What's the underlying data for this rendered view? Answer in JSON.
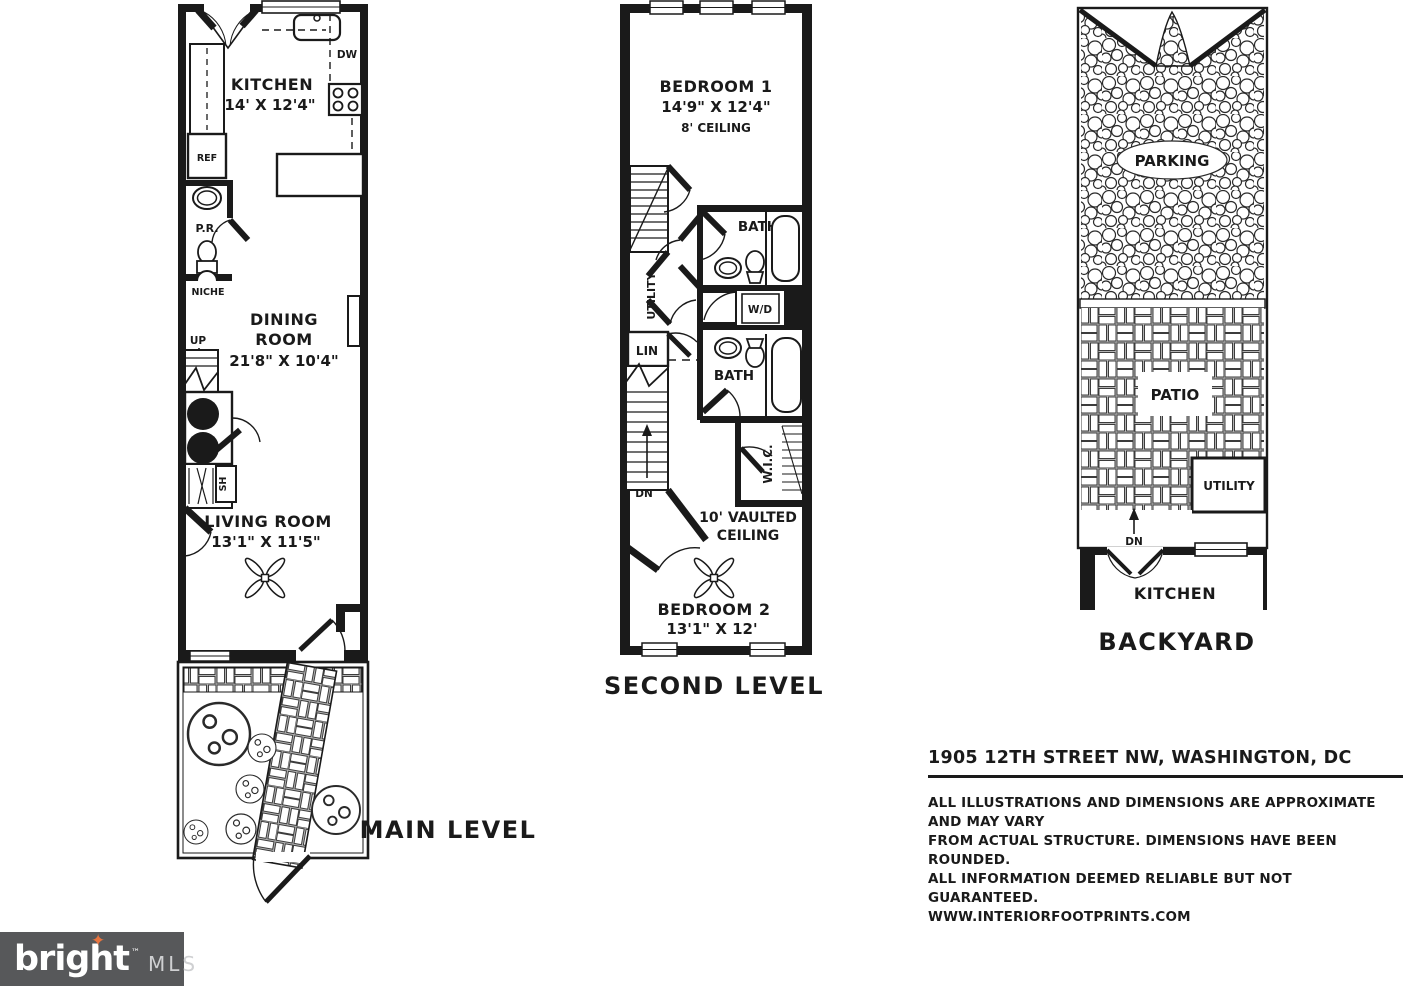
{
  "main_level": {
    "title": "MAIN LEVEL",
    "kitchen_name": "KITCHEN",
    "kitchen_dims": "14' X 12'4\"",
    "dining_line1": "DINING",
    "dining_line2": "ROOM",
    "dining_dims": "21'8\" X 10'4\"",
    "living_name": "LIVING ROOM",
    "living_dims": "13'1\" X 11'5\"",
    "labels": {
      "dw": "DW",
      "ref": "REF",
      "pr": "P.R.",
      "niche": "NICHE",
      "up": "UP",
      "sh": "SH"
    }
  },
  "second_level": {
    "title": "SECOND LEVEL",
    "bedroom1_name": "BEDROOM 1",
    "bedroom1_dims": "14'9\" X 12'4\"",
    "bedroom1_ceiling": "8' CEILING",
    "bedroom2_name": "BEDROOM 2",
    "bedroom2_dims": "13'1\" X 12'",
    "vaulted_line1": "10' VAULTED",
    "vaulted_line2": "CEILING",
    "labels": {
      "bath1": "BATH",
      "bath2": "BATH",
      "wd": "W/D",
      "utility": "UTILITY",
      "lin": "LIN",
      "wic": "W.I.C.",
      "dn": "DN"
    }
  },
  "backyard": {
    "title": "BACKYARD",
    "labels": {
      "parking": "PARKING",
      "patio": "PATIO",
      "utility": "UTILITY",
      "kitchen": "KITCHEN",
      "dn": "DN"
    }
  },
  "footer": {
    "address": "1905 12TH STREET NW, WASHINGTON, DC",
    "disclaimer": [
      "ALL ILLUSTRATIONS AND DIMENSIONS ARE APPROXIMATE AND MAY VARY",
      "FROM ACTUAL STRUCTURE. DIMENSIONS HAVE BEEN ROUNDED.",
      "ALL INFORMATION DEEMED RELIABLE BUT NOT GUARANTEED.",
      "WWW.INTERIORFOOTPRINTS.COM"
    ]
  },
  "logo": {
    "brand": "bright",
    "tm": "™",
    "suffix": "MLS",
    "star_glyph": "✦",
    "background": "#57585a",
    "star_color": "#e8743f"
  }
}
